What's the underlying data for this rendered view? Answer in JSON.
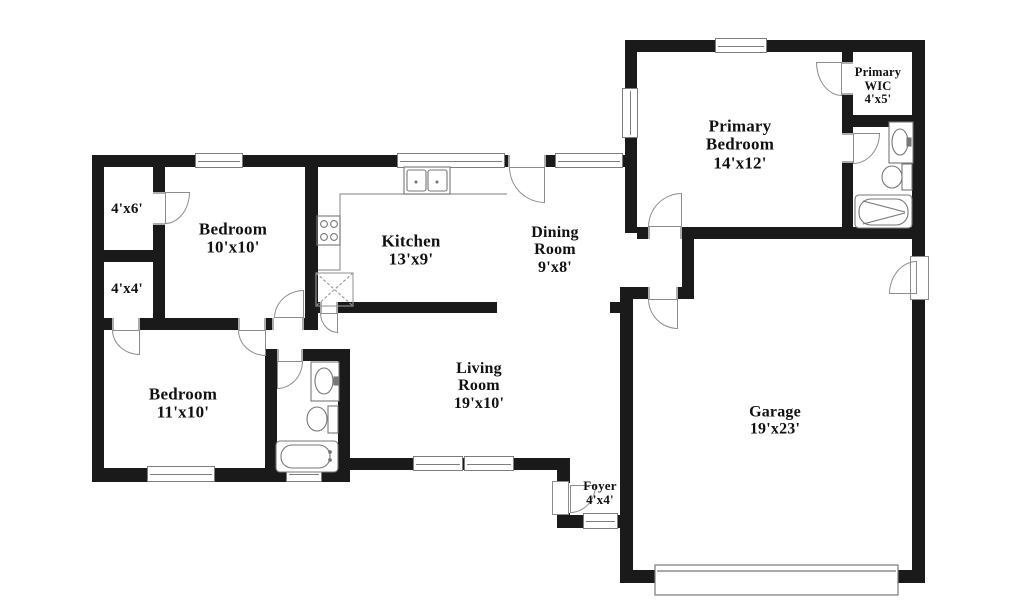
{
  "title": "Residential floor plan",
  "colors": {
    "wall": "#1a1a1a",
    "detail": "#8c8c8c",
    "text": "#111111"
  },
  "rooms": {
    "closet_4x6": {
      "lines": [
        "4'x6'"
      ]
    },
    "closet_4x4": {
      "lines": [
        "4'x4'"
      ]
    },
    "bedroom_10x10": {
      "lines": [
        "Bedroom",
        "10'x10'"
      ]
    },
    "kitchen": {
      "lines": [
        "Kitchen",
        "13'x9'"
      ]
    },
    "dining_room": {
      "lines": [
        "Dining",
        "Room",
        "9'x8'"
      ]
    },
    "primary_bedroom": {
      "lines": [
        "Primary",
        "Bedroom",
        "14'x12'"
      ]
    },
    "primary_wic": {
      "lines": [
        "Primary",
        "WIC",
        "4'x5'"
      ]
    },
    "bedroom_11x10": {
      "lines": [
        "Bedroom",
        "11'x10'"
      ]
    },
    "living_room": {
      "lines": [
        "Living",
        "Room",
        "19'x10'"
      ]
    },
    "foyer": {
      "lines": [
        "Foyer",
        "4'x4'"
      ]
    },
    "garage": {
      "lines": [
        "Garage",
        "19'x23'"
      ]
    }
  }
}
